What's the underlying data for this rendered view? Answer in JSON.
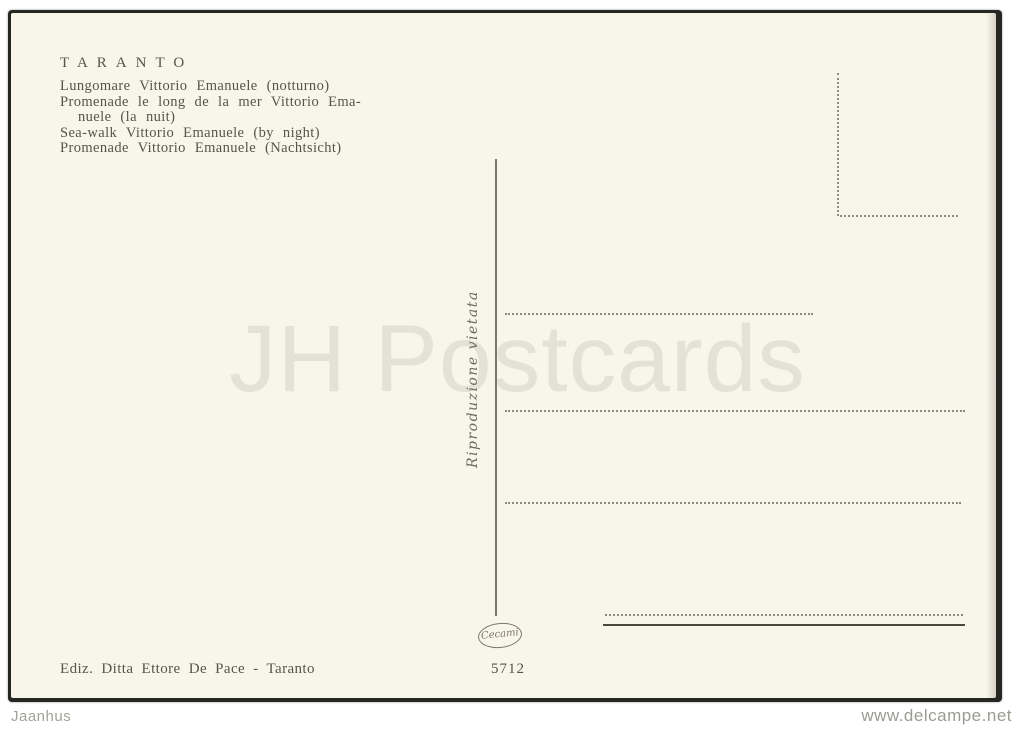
{
  "card": {
    "title": "TARANTO",
    "caption_lines": [
      "Lungomare Vittorio Emanuele (notturno)",
      "Promenade le long de la mer Vittorio Ema-",
      "nuele (la nuit)",
      "Sea-walk Vittorio Emanuele (by night)",
      "Promenade Vittorio Emanuele (Nachtsicht)"
    ],
    "divider_note": "Riproduzione vietata",
    "publisher": "Ediz. Ditta Ettore De Pace - Taranto",
    "serial_number": "5712",
    "printer_logo": "Cecami",
    "watermark": "JH Postcards"
  },
  "footer": {
    "left": "Jaanhus",
    "right": "www.delcampe.net"
  },
  "colors": {
    "paper": "#f8f5e9",
    "ink": "#57544a",
    "watermark": "#e4e2d7",
    "dotted_line": "#8d897b",
    "scan_edge": "#262622"
  }
}
